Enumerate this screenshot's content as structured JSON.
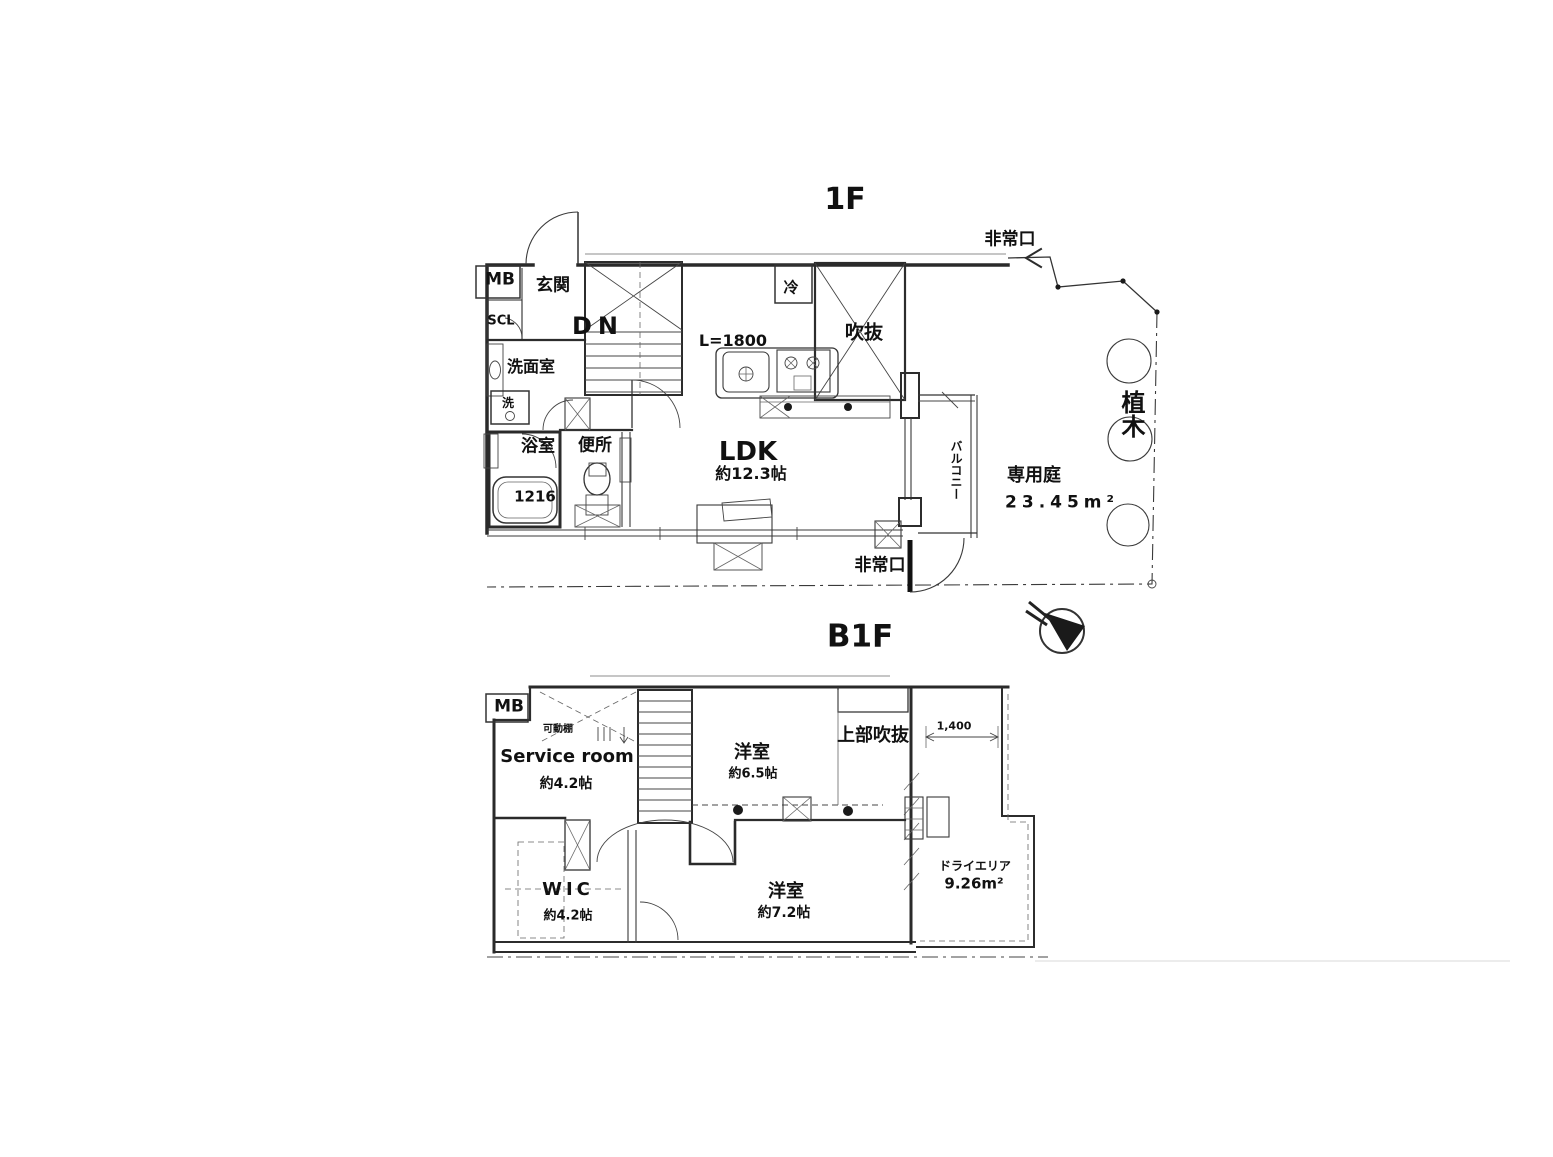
{
  "meta": {
    "background": "#ffffff",
    "line_color": "#2a2a2a",
    "text_color": "#111111"
  },
  "floor_1f": {
    "title": "1F",
    "emergency_exit_top": "非常口",
    "emergency_exit_bottom": "非常口",
    "meter_box": "MB",
    "entrance": "玄関",
    "shoe_closet": "SCL",
    "stairs_down": "DN",
    "washroom": "洗面室",
    "washing_machine": "洗",
    "bathroom": "浴室",
    "bathtub_size": "1216",
    "toilet": "便所",
    "refrigerator": "冷",
    "void_space": "吹抜",
    "kitchen_length": "L=1800",
    "ldk": "LDK",
    "ldk_size": "約12.3帖",
    "balcony": "バルコニー",
    "private_garden": "専用庭",
    "private_garden_area": "23.45m²",
    "planting": "植木"
  },
  "floor_b1f": {
    "title": "B1F",
    "meter_box": "MB",
    "movable_shelf": "可動棚",
    "service_room": "Service room",
    "service_room_size": "約4.2帖",
    "bedroom_1": "洋室",
    "bedroom_1_size": "約6.5帖",
    "upper_void": "上部吹抜",
    "dimension_1400": "1,400",
    "walk_in_closet": "WIC",
    "walk_in_closet_size": "約4.2帖",
    "bedroom_2": "洋室",
    "bedroom_2_size": "約7.2帖",
    "dry_area": "ドライエリア",
    "dry_area_size": "9.26m²"
  }
}
